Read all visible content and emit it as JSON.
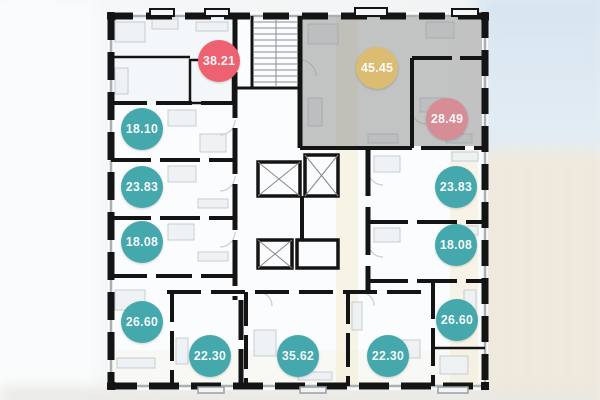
{
  "floorplan": {
    "type": "residential-floor-plan",
    "units_total": 13,
    "overlay_color": "#8d8d8d",
    "wall_color": "#141414"
  },
  "colors": {
    "available_teal": "#44a8ad",
    "highlight_red": "#ee6170",
    "selected_gold": "#dcbc72",
    "selected_pink": "#d68d96"
  },
  "badges": [
    {
      "value": "38.21",
      "color": "#ee6170"
    },
    {
      "value": "45.45",
      "color": "#dcbc72"
    },
    {
      "value": "28.49",
      "color": "#d68d96"
    },
    {
      "value": "18.10",
      "color": "#44a8ad"
    },
    {
      "value": "23.83",
      "color": "#44a8ad"
    },
    {
      "value": "18.08",
      "color": "#44a8ad"
    },
    {
      "value": "26.60",
      "color": "#44a8ad"
    },
    {
      "value": "22.30",
      "color": "#44a8ad"
    },
    {
      "value": "35.62",
      "color": "#44a8ad"
    },
    {
      "value": "22.30",
      "color": "#44a8ad"
    },
    {
      "value": "23.83",
      "color": "#44a8ad"
    },
    {
      "value": "18.08",
      "color": "#44a8ad"
    },
    {
      "value": "26.60",
      "color": "#44a8ad"
    }
  ]
}
